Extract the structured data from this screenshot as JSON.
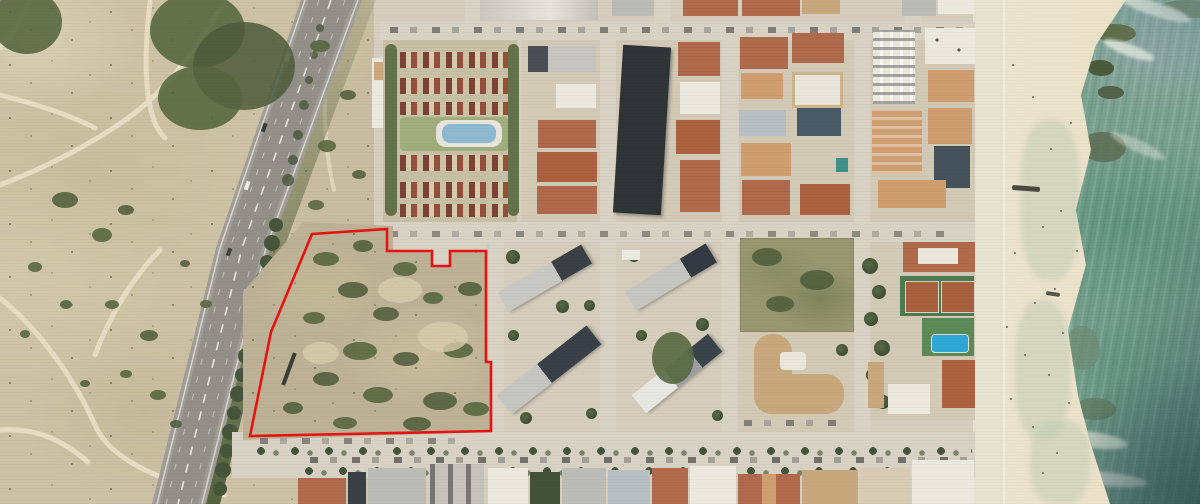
{
  "image": {
    "kind": "aerial-orthophoto",
    "description": "Coastal town aerial view with a vacant land parcel outlined in red, a diagonal highway and dune scrubland on the left, an urban street grid in the center, and a beach with sea on the right",
    "visible_text": "none"
  },
  "annotation": {
    "parcel_outline": {
      "color": "#e41310",
      "stroke_width": 2.6,
      "points": "312,234 387,229 387,251 432,251 432,266 450,266 450,251 486,251 486,362 491,362 491,431 250,436 271,332"
    }
  },
  "features": {
    "dune_scrubland": {
      "position": "left",
      "sand_color": "#cdc2a5",
      "scrub_color": "#55663f"
    },
    "highway": {
      "orientation": "diagonal top-right to bottom-left",
      "surface_color": "#a09e99",
      "marking_color": "#f2f0e8"
    },
    "vacant_parcel": {
      "state": "unbuilt scrub lot",
      "ground_color": "#bdb296"
    },
    "urban_blocks": {
      "roof_colors": [
        "#b06a4c",
        "#3a4046",
        "#bdbdb7",
        "#eceadf",
        "#cf9f72"
      ]
    },
    "residential_complex_pool": {
      "water_color": "#8fb9cf"
    },
    "community_pool": {
      "water_color": "#2fa8d5"
    },
    "tennis_courts": {
      "count": 2,
      "court_color": "#a8603f",
      "surround_color": "#4e7a50"
    },
    "beach": {
      "sand_color": "#ece2c9"
    },
    "sea": {
      "base_color": "#7aa190",
      "deep_color": "#2a4c50",
      "foam_color": "#e2eade"
    }
  }
}
